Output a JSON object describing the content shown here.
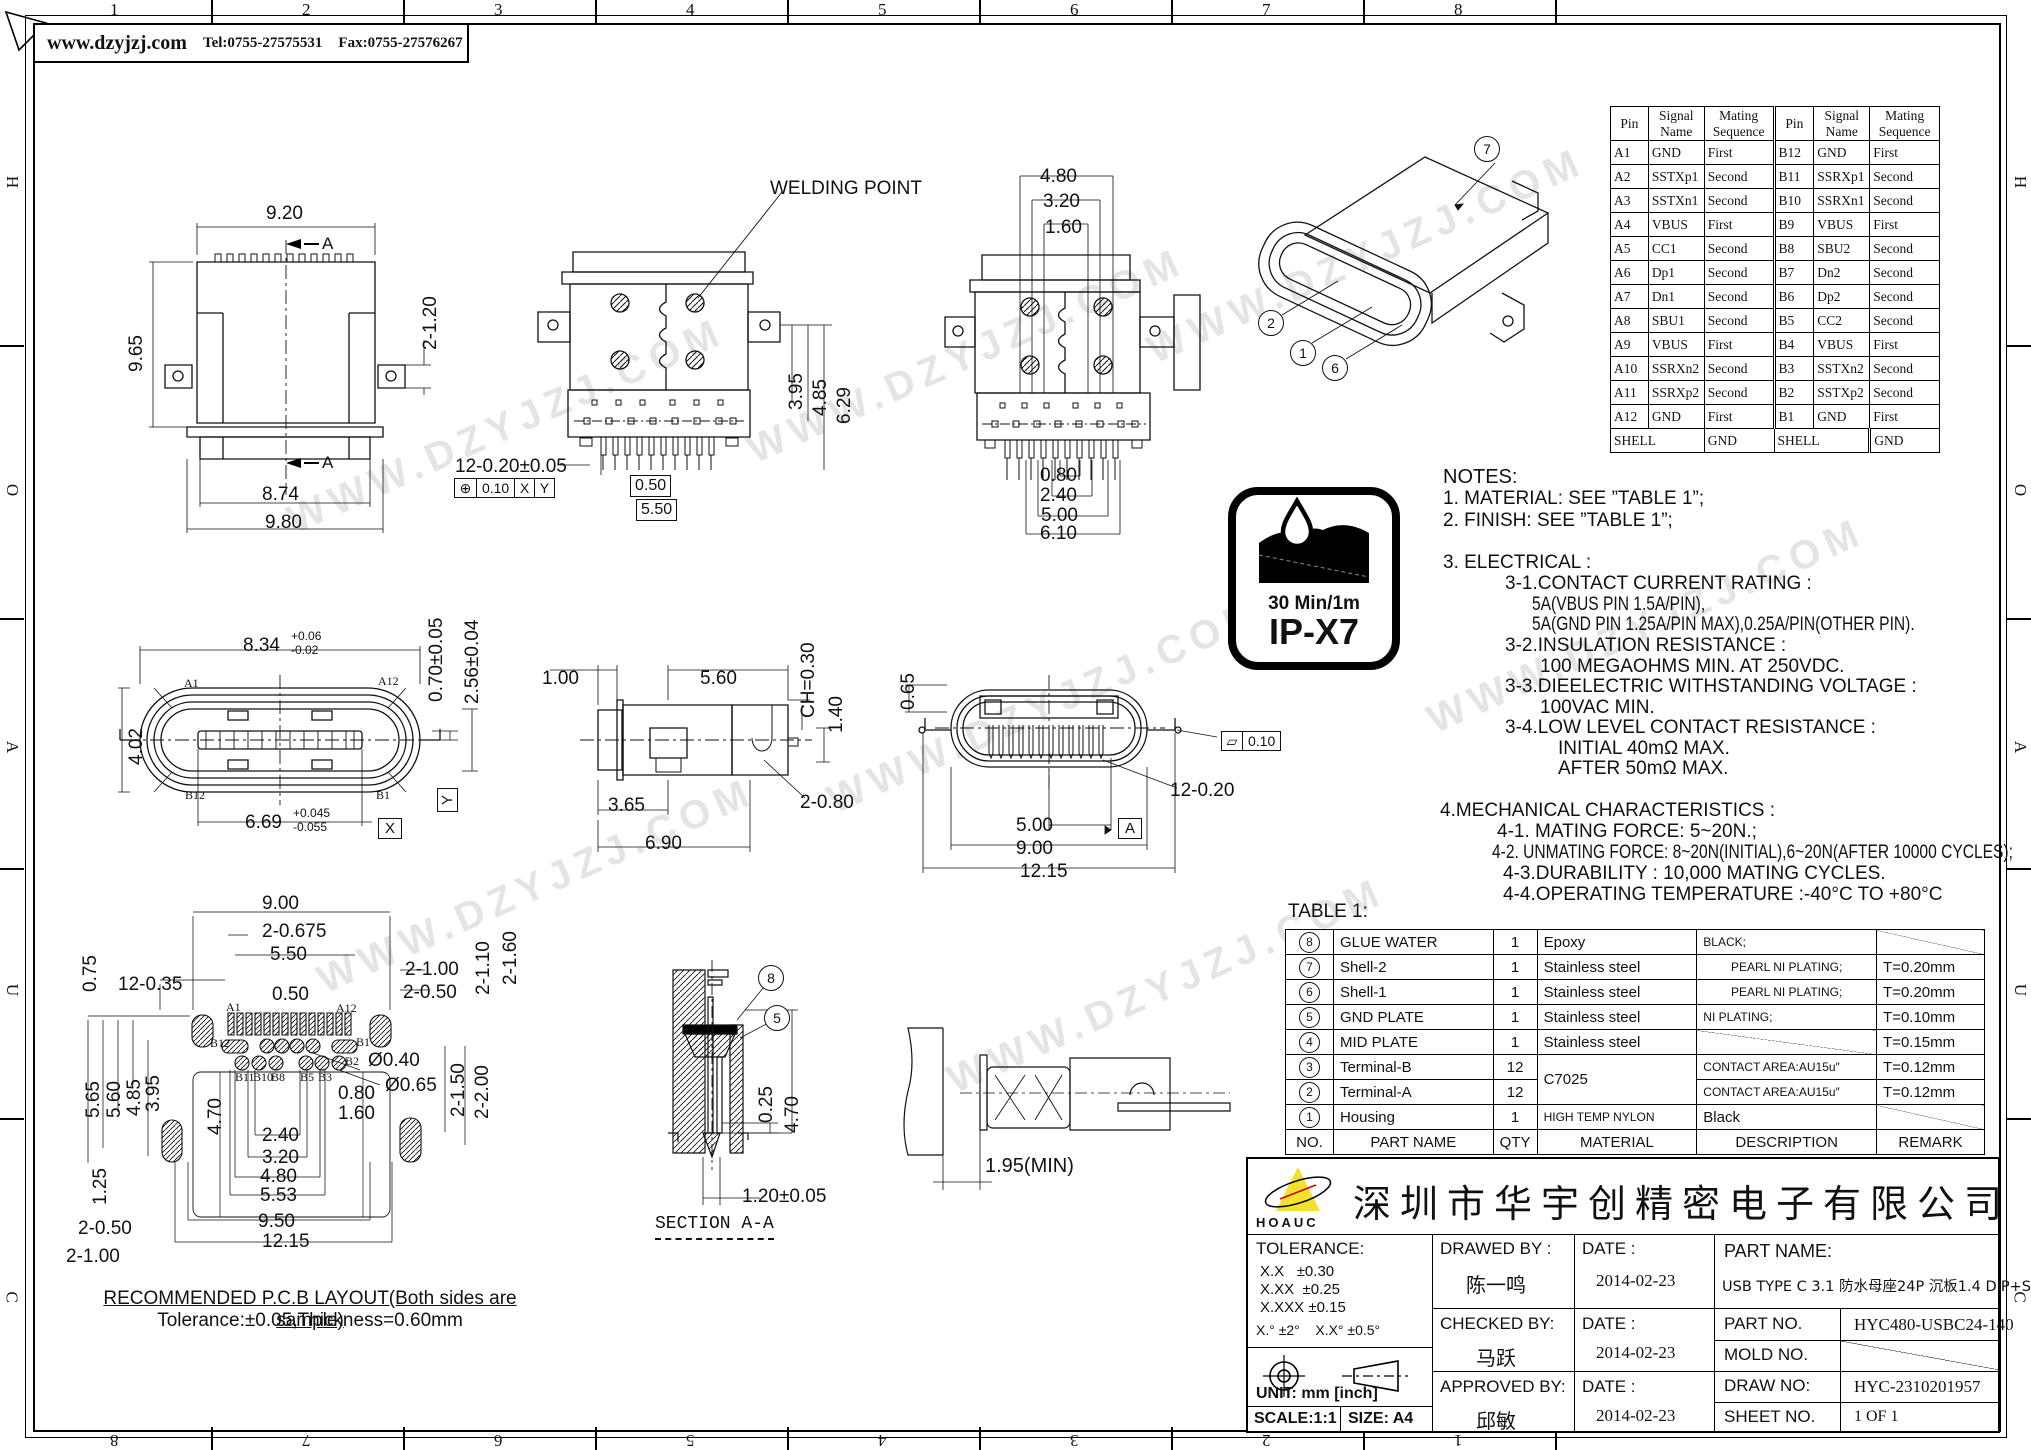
{
  "frame": {
    "website": "www.dzyjzj.com",
    "tel": "Tel:0755-27575531",
    "fax": "Fax:0755-27576267",
    "zone_cols": [
      "1",
      "2",
      "3",
      "4",
      "5",
      "6",
      "7",
      "8"
    ],
    "zone_letters": [
      "H",
      "O",
      "A",
      "U",
      "C"
    ]
  },
  "watermark": "WWW.DZYJZJ.COM",
  "pin_table": {
    "headers": [
      "Pin",
      "Signal\nName",
      "Mating\nSequence",
      "Pin",
      "Signal\nName",
      "Mating\nSequence"
    ],
    "rows": [
      [
        "A1",
        "GND",
        "First",
        "B12",
        "GND",
        "First"
      ],
      [
        "A2",
        "SSTXp1",
        "Second",
        "B11",
        "SSRXp1",
        "Second"
      ],
      [
        "A3",
        "SSTXn1",
        "Second",
        "B10",
        "SSRXn1",
        "Second"
      ],
      [
        "A4",
        "VBUS",
        "First",
        "B9",
        "VBUS",
        "First"
      ],
      [
        "A5",
        "CC1",
        "Second",
        "B8",
        "SBU2",
        "Second"
      ],
      [
        "A6",
        "Dp1",
        "Second",
        "B7",
        "Dn2",
        "Second"
      ],
      [
        "A7",
        "Dn1",
        "Second",
        "B6",
        "Dp2",
        "Second"
      ],
      [
        "A8",
        "SBU1",
        "Second",
        "B5",
        "CC2",
        "Second"
      ],
      [
        "A9",
        "VBUS",
        "First",
        "B4",
        "VBUS",
        "First"
      ],
      [
        "A10",
        "SSRXn2",
        "Second",
        "B3",
        "SSTXn2",
        "Second"
      ],
      [
        "A11",
        "SSRXp2",
        "Second",
        "B2",
        "SSTXp2",
        "Second"
      ],
      [
        "A12",
        "GND",
        "First",
        "B1",
        "GND",
        "First"
      ]
    ],
    "shell": {
      "label": "SHELL",
      "val": "GND"
    }
  },
  "notes": [
    "NOTES:",
    "1. MATERIAL: SEE ”TABLE 1”;",
    "2. FINISH: SEE ”TABLE 1”;",
    "3. ELECTRICAL :",
    "3-1.CONTACT CURRENT RATING :",
    "5A(VBUS PIN 1.5A/PIN),",
    "5A(GND PIN 1.25A/PIN MAX),0.25A/PIN(OTHER PIN).",
    "3-2.INSULATION RESISTANCE :",
    "100 MEGAOHMS MIN. AT 250VDC.",
    "3-3.DIEELECTRIC WITHSTANDING VOLTAGE :",
    "100VAC MIN.",
    "3-4.LOW LEVEL CONTACT RESISTANCE :",
    "INITIAL 40mΩ MAX.",
    "AFTER 50mΩ MAX.",
    "4.MECHANICAL CHARACTERISTICS :",
    "4-1. MATING FORCE: 5~20N.;",
    "4-2. UNMATING FORCE: 8~20N(INITIAL),6~20N(AFTER 10000 CYCLES);",
    "4-3.DURABILITY : 10,000 MATING CYCLES.",
    "4-4.OPERATING TEMPERATURE :-40°C TO +80°C"
  ],
  "ip_badge": {
    "duration": "30 Min/1m",
    "rating": "IP-X7"
  },
  "table1": {
    "title": "TABLE 1:",
    "footer": [
      "NO.",
      "PART NAME",
      "QTY",
      "MATERIAL",
      "DESCRIPTION",
      "REMARK"
    ],
    "rows": [
      {
        "no": "8",
        "name": "GLUE WATER",
        "qty": "1",
        "mat": "Epoxy",
        "desc": "BLACK;",
        "rem": ""
      },
      {
        "no": "7",
        "name": "Shell-2",
        "qty": "1",
        "mat": "Stainless steel",
        "desc": "PEARL NI PLATING;",
        "rem": "T=0.20mm"
      },
      {
        "no": "6",
        "name": "Shell-1",
        "qty": "1",
        "mat": "Stainless steel",
        "desc": "PEARL NI PLATING;",
        "rem": "T=0.20mm"
      },
      {
        "no": "5",
        "name": "GND PLATE",
        "qty": "1",
        "mat": "Stainless steel",
        "desc": "NI PLATING;",
        "rem": "T=0.10mm"
      },
      {
        "no": "4",
        "name": "MID PLATE",
        "qty": "1",
        "mat": "Stainless steel",
        "desc": "",
        "rem": "T=0.15mm"
      },
      {
        "no": "3",
        "name": "Terminal-B",
        "qty": "12",
        "mat": "C7025",
        "desc": "CONTACT AREA:AU15u″",
        "rem": "T=0.12mm"
      },
      {
        "no": "2",
        "name": "Terminal-A",
        "qty": "12",
        "mat": "",
        "desc": "CONTACT AREA:AU15u″",
        "rem": "T=0.12mm"
      },
      {
        "no": "1",
        "name": "Housing",
        "qty": "1",
        "mat": "HIGH TEMP NYLON",
        "desc": "Black",
        "rem": ""
      }
    ]
  },
  "title_block": {
    "company": "深圳市华宇创精密电子有限公司",
    "logo": "HOAUC",
    "tolerance_label": "TOLERANCE:",
    "tol_rows": [
      {
        "k": "X.X",
        "v": "±0.30"
      },
      {
        "k": "X.XX",
        "v": "±0.25"
      },
      {
        "k": "X.XXX",
        "v": "±0.15"
      }
    ],
    "ang1": "X.°  ±2°",
    "ang2": "X.X°  ±0.5°",
    "unit": "UNIT:  mm  [inch]",
    "scale": "SCALE:1:1",
    "size": "SIZE:  A4",
    "drawn_label": "DRAWED BY :",
    "drawn_name": "陈一鸣",
    "checked_label": "CHECKED BY:",
    "checked_name": "马跃",
    "approved_label": "APPROVED BY:",
    "approved_name": "邱敏",
    "date_label": "DATE :",
    "dates": [
      "2014-02-23",
      "2014-02-23",
      "2014-02-23"
    ],
    "part_name_label": "PART NAME:",
    "part_name": "USB TYPE C 3.1 防水母座24P 沉板1.4 DIP+SMT",
    "part_no_label": "PART NO.",
    "part_no": "HYC480-USBC24-140",
    "mold_label": "MOLD NO.",
    "draw_label": "DRAW NO:",
    "draw_no": "HYC-2310201957",
    "sheet_label": "SHEET NO.",
    "sheet_no": "1 OF 1"
  },
  "views": {
    "v1": {
      "dims": [
        "9.20",
        "9.65",
        "2-1.20",
        "8.74",
        "9.80"
      ],
      "section": "A"
    },
    "v2": {
      "label": "WELDING POINT",
      "dims": [
        "12-0.20±0.05",
        "0.50",
        "5.50",
        "3.95",
        "4.85",
        "6.29"
      ],
      "gdt": {
        "sym": "⊕",
        "tol": "0.10",
        "a": "X",
        "b": "Y"
      }
    },
    "v3": {
      "dims": [
        "4.80",
        "3.20",
        "1.60",
        "0.80",
        "2.40",
        "5.00",
        "6.10"
      ]
    },
    "iso": {
      "callouts": [
        "7",
        "2",
        "1",
        "6"
      ]
    },
    "v5": {
      "dims": [
        "8.34",
        "+0.06",
        "-0.02",
        "4.02",
        "0.70±0.05",
        "2.56±0.04",
        "6.69",
        "+0.045",
        "-0.055"
      ],
      "pins": [
        "A1",
        "A12",
        "B12",
        "B1"
      ],
      "datum_x": "X",
      "datum_y": "Y"
    },
    "v6": {
      "dims": [
        "1.00",
        "5.60",
        "CH=0.30",
        "1.40",
        "3.65",
        "6.90",
        "2-0.80"
      ]
    },
    "v7": {
      "dims": [
        "0.65",
        "12-0.20",
        "5.00",
        "9.00",
        "12.15"
      ],
      "flat": {
        "sym": "▱",
        "tol": "0.10"
      },
      "datum": "A"
    },
    "pcb": {
      "dims": [
        "9.00",
        "2-0.675",
        "5.50",
        "0.75",
        "12-0.35",
        "0.50",
        "2-1.00",
        "2-0.50",
        "2-1.10",
        "2-1.60",
        "5.65",
        "5.60",
        "4.85",
        "3.95",
        "4.70",
        "Ø0.40",
        "Ø0.65",
        "0.80",
        "1.60",
        "2.40",
        "3.20",
        "4.80",
        "5.53",
        "1.25",
        "2-0.50",
        "2-1.00",
        "9.50",
        "12.15",
        "2-1.50",
        "2-2.00"
      ],
      "pins": [
        "A1",
        "A12",
        "B12",
        "B1",
        "B2",
        "B11",
        "B10",
        "B8",
        "B5",
        "B3"
      ],
      "caption1": "RECOMMENDED P.C.B LAYOUT(Both sides are sample)",
      "caption2": "Tolerance:±0.05,Thickness=0.60mm"
    },
    "saa": {
      "label": "SECTION A-A",
      "callouts": [
        "8",
        "5"
      ],
      "dims": [
        "0.25",
        "4.70",
        "1.20±0.05"
      ]
    },
    "v8": {
      "dims": [
        "1.95(MIN)"
      ]
    }
  }
}
